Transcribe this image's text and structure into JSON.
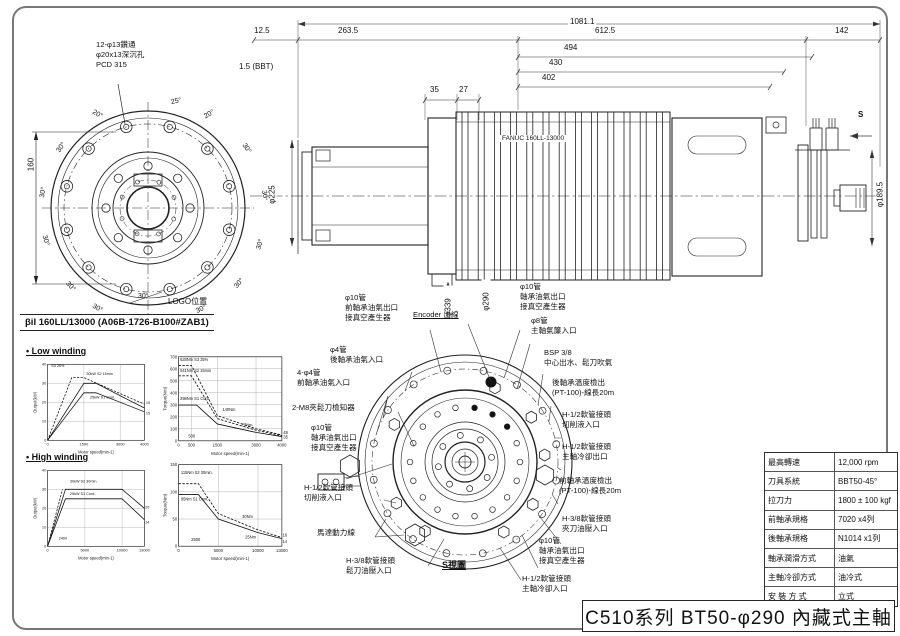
{
  "sheet": {
    "title_block": "C510系列 BT50-φ290 內藏式主軸"
  },
  "front_view": {
    "callout": "12-φ13鑽通\nφ20x13深沉孔\nPCD 315",
    "logo_label": "LOGO位置",
    "dim_160": "160",
    "angle_labels": [
      "25°",
      "20°",
      "20°",
      "30°",
      "30°",
      "30°",
      "30°",
      "30°",
      "30°",
      "30°",
      "30°",
      "30°",
      "30°",
      "30°"
    ]
  },
  "side_view": {
    "motor_text": "FANUC 160LL-13000",
    "dims": {
      "overall": "1081.1",
      "left_offset": "12.5",
      "front_section": "263.5",
      "motor_section": "612.5",
      "rear_section": "142",
      "l494": "494",
      "l430": "430",
      "l402": "402",
      "l35": "35",
      "l27": "27",
      "gauge": "1.5 (BBT)",
      "dia_front": "φ225",
      "dia_flange": "φ339",
      "dia_body": "φ290",
      "dia_rear": "φ189.5",
      "view_mark": "S"
    }
  },
  "motor_curves": {
    "header": "βiI 160LL/13000 (A06B-1726-B100#ZAB1)",
    "low_winding_label": "• Low winding",
    "high_winding_label": "• High winding"
  },
  "s_view": {
    "view_label": "S視圖",
    "labels_left": [
      {
        "text": "φ10管\n前軸承油氣出口\n接真空產生器"
      },
      {
        "text": "Encoder 出線"
      },
      {
        "text": "φ4管\n後軸承油氣入口"
      },
      {
        "text": "4-φ4管\n前軸承油氣入口"
      },
      {
        "text": "2-M8夾鬆刀檢知器"
      },
      {
        "text": "φ10管\n軸承油氣出口\n接真空產生器"
      },
      {
        "text": "H-1/2軟管接頭\n切削液入口"
      },
      {
        "text": "馬達動力線"
      },
      {
        "text": "H-3/8軟管接頭\n鬆刀油壓入口"
      }
    ],
    "labels_right": [
      {
        "text": "φ10管\n軸承油氣出口\n接真空產生器"
      },
      {
        "text": "φ8管\n主軸氣簾入口"
      },
      {
        "text": "BSP 3/8\n中心出水、鬆刀吹氣"
      },
      {
        "text": "後軸承溫度檢出\n(PT-100)-線長20m"
      },
      {
        "text": "H-1/2軟管接頭\n切削液入口"
      },
      {
        "text": "H-1/2軟管接頭\n主軸冷卻出口"
      },
      {
        "text": "前軸承溫度檢出\n(PT-100)-線長20m"
      },
      {
        "text": "H-3/8軟管接頭\n夾刀油壓入口"
      },
      {
        "text": "φ10管\n軸承油氣出口\n接真空產生器"
      },
      {
        "text": "H-1/2軟管接頭\n主軸冷卻入口"
      }
    ]
  },
  "spec_table": {
    "rows": [
      {
        "label": "最高轉速",
        "value": "12,000 rpm"
      },
      {
        "label": "刀具系統",
        "value": "BBT50-45°"
      },
      {
        "label": "拉刀力",
        "value": "1800 ± 100 kgf"
      },
      {
        "label": "前軸承規格",
        "value": "7020 x4列"
      },
      {
        "label": "後軸承規格",
        "value": "N1014 x1列"
      },
      {
        "label": "軸承潤滑方式",
        "value": "油氣"
      },
      {
        "label": "主軸冷卻方式",
        "value": "油冷式"
      },
      {
        "label": "安 裝 方 式",
        "value": "立式"
      }
    ]
  },
  "chart_data": [
    {
      "id": "low-winding-output",
      "type": "line",
      "xlabel": "Motor speed(min-1)",
      "ylabel": "Output(kW)",
      "xlim": [
        0,
        4000
      ],
      "ylim": [
        0,
        40
      ],
      "xticks": [
        0,
        1500,
        3000,
        4000
      ],
      "yticks": [
        0,
        10,
        20,
        30,
        40
      ],
      "series": [
        {
          "name": "S3 25%",
          "dashed": true,
          "points": [
            [
              0,
              0
            ],
            [
              1000,
              33
            ],
            [
              1500,
              33
            ],
            [
              4000,
              19
            ]
          ]
        },
        {
          "name": "S2 15min",
          "dashed": false,
          "points": [
            [
              0,
              0
            ],
            [
              1500,
              30
            ],
            [
              2000,
              30
            ],
            [
              4000,
              17
            ]
          ]
        },
        {
          "name": "S1 Cont.",
          "dashed": false,
          "points": [
            [
              0,
              0
            ],
            [
              1500,
              25
            ],
            [
              2000,
              25
            ],
            [
              4000,
              15
            ]
          ]
        }
      ],
      "annotations": [
        {
          "x": 150,
          "y": 38.5,
          "text": "S3 25%"
        },
        {
          "x": 1600,
          "y": 34.5,
          "text": "30kW S2 15min"
        },
        {
          "x": 1750,
          "y": 22,
          "text": "25kW S1 Cont."
        },
        {
          "x": 4060,
          "y": 19,
          "text": "19"
        },
        {
          "x": 4060,
          "y": 13.5,
          "text": "15"
        }
      ]
    },
    {
      "id": "low-winding-torque",
      "type": "line",
      "xlabel": "Motor speed(min-1)",
      "ylabel": "Torque(Nm)",
      "xlim": [
        0,
        4000
      ],
      "ylim": [
        0,
        700
      ],
      "xticks": [
        0,
        500,
        1500,
        3000,
        4000
      ],
      "yticks": [
        0,
        100,
        200,
        300,
        400,
        500,
        600,
        700
      ],
      "series": [
        {
          "name": "S3 25%",
          "dashed": true,
          "points": [
            [
              0,
              628
            ],
            [
              500,
              628
            ],
            [
              1500,
              210
            ],
            [
              3000,
              100
            ],
            [
              4000,
              48
            ]
          ]
        },
        {
          "name": "S2 15min",
          "dashed": true,
          "points": [
            [
              0,
              541
            ],
            [
              500,
              541
            ],
            [
              1500,
              185
            ],
            [
              3000,
              88
            ],
            [
              4000,
              42
            ]
          ]
        },
        {
          "name": "S1 Cont.",
          "dashed": false,
          "points": [
            [
              0,
              298
            ],
            [
              700,
              298
            ],
            [
              1500,
              140
            ],
            [
              3000,
              70
            ],
            [
              4000,
              35
            ]
          ]
        }
      ],
      "annotations": [
        {
          "x": 60,
          "y": 665,
          "text": "628Nm S3 25%"
        },
        {
          "x": 60,
          "y": 575,
          "text": "541Nm S2 15min"
        },
        {
          "x": 60,
          "y": 340,
          "text": "298Nm S1 Cont."
        },
        {
          "x": 1700,
          "y": 250,
          "text": "140Nm"
        },
        {
          "x": 2450,
          "y": 120,
          "text": "77Nm"
        },
        {
          "x": 4060,
          "y": 55,
          "text": "48"
        },
        {
          "x": 4060,
          "y": 18,
          "text": "35"
        },
        {
          "x": 380,
          "y": 28,
          "text": "500"
        }
      ]
    },
    {
      "id": "high-winding-output",
      "type": "line",
      "xlabel": "Motor speed(min-1)",
      "ylabel": "Output(kW)",
      "xlim": [
        0,
        13000
      ],
      "ylim": [
        0,
        40
      ],
      "xticks": [
        0,
        5000,
        10000,
        13000
      ],
      "yticks": [
        0,
        10,
        20,
        30,
        40
      ],
      "series": [
        {
          "name": "S2 30min accel",
          "dashed": true,
          "points": [
            [
              0,
              0
            ],
            [
              2000,
              30
            ]
          ]
        },
        {
          "name": "S2 30min",
          "dashed": false,
          "points": [
            [
              0,
              0
            ],
            [
              2400,
              30
            ],
            [
              10000,
              30
            ],
            [
              13000,
              20
            ]
          ]
        },
        {
          "name": "S1 Cont.",
          "dashed": false,
          "points": [
            [
              0,
              0
            ],
            [
              2400,
              25
            ],
            [
              10000,
              25
            ],
            [
              13000,
              14
            ]
          ]
        }
      ],
      "annotations": [
        {
          "x": 3000,
          "y": 33.5,
          "text": "30kW S2 30min."
        },
        {
          "x": 3000,
          "y": 27,
          "text": "25kW S1 Cont."
        },
        {
          "x": 1500,
          "y": 3.5,
          "text": "2400"
        },
        {
          "x": 13100,
          "y": 20,
          "text": "20"
        },
        {
          "x": 13100,
          "y": 12,
          "text": "14"
        }
      ]
    },
    {
      "id": "high-winding-torque",
      "type": "line",
      "xlabel": "Motor speed(min-1)",
      "ylabel": "Torque(Nm)",
      "xlim": [
        0,
        13000
      ],
      "ylim": [
        0,
        150
      ],
      "xticks": [
        0,
        5000,
        10000,
        13000
      ],
      "yticks": [
        0,
        50,
        100,
        150
      ],
      "series": [
        {
          "name": "S2 30min",
          "dashed": true,
          "points": [
            [
              0,
              115
            ],
            [
              2500,
              115
            ],
            [
              5000,
              60
            ],
            [
              10000,
              30
            ],
            [
              13000,
              16
            ]
          ]
        },
        {
          "name": "S1 Cont.",
          "dashed": false,
          "points": [
            [
              0,
              95
            ],
            [
              2500,
              95
            ],
            [
              5000,
              50
            ],
            [
              10000,
              25
            ],
            [
              13000,
              14
            ]
          ]
        }
      ],
      "annotations": [
        {
          "x": 300,
          "y": 133,
          "text": "115Nm S2 30min."
        },
        {
          "x": 300,
          "y": 84,
          "text": "95Nm S1 Cont."
        },
        {
          "x": 1600,
          "y": 10,
          "text": "2500"
        },
        {
          "x": 8000,
          "y": 52,
          "text": "30Nm"
        },
        {
          "x": 8400,
          "y": 14,
          "text": "25Nm"
        },
        {
          "x": 13100,
          "y": 18,
          "text": "16"
        },
        {
          "x": 13100,
          "y": 6,
          "text": "14"
        }
      ]
    }
  ]
}
